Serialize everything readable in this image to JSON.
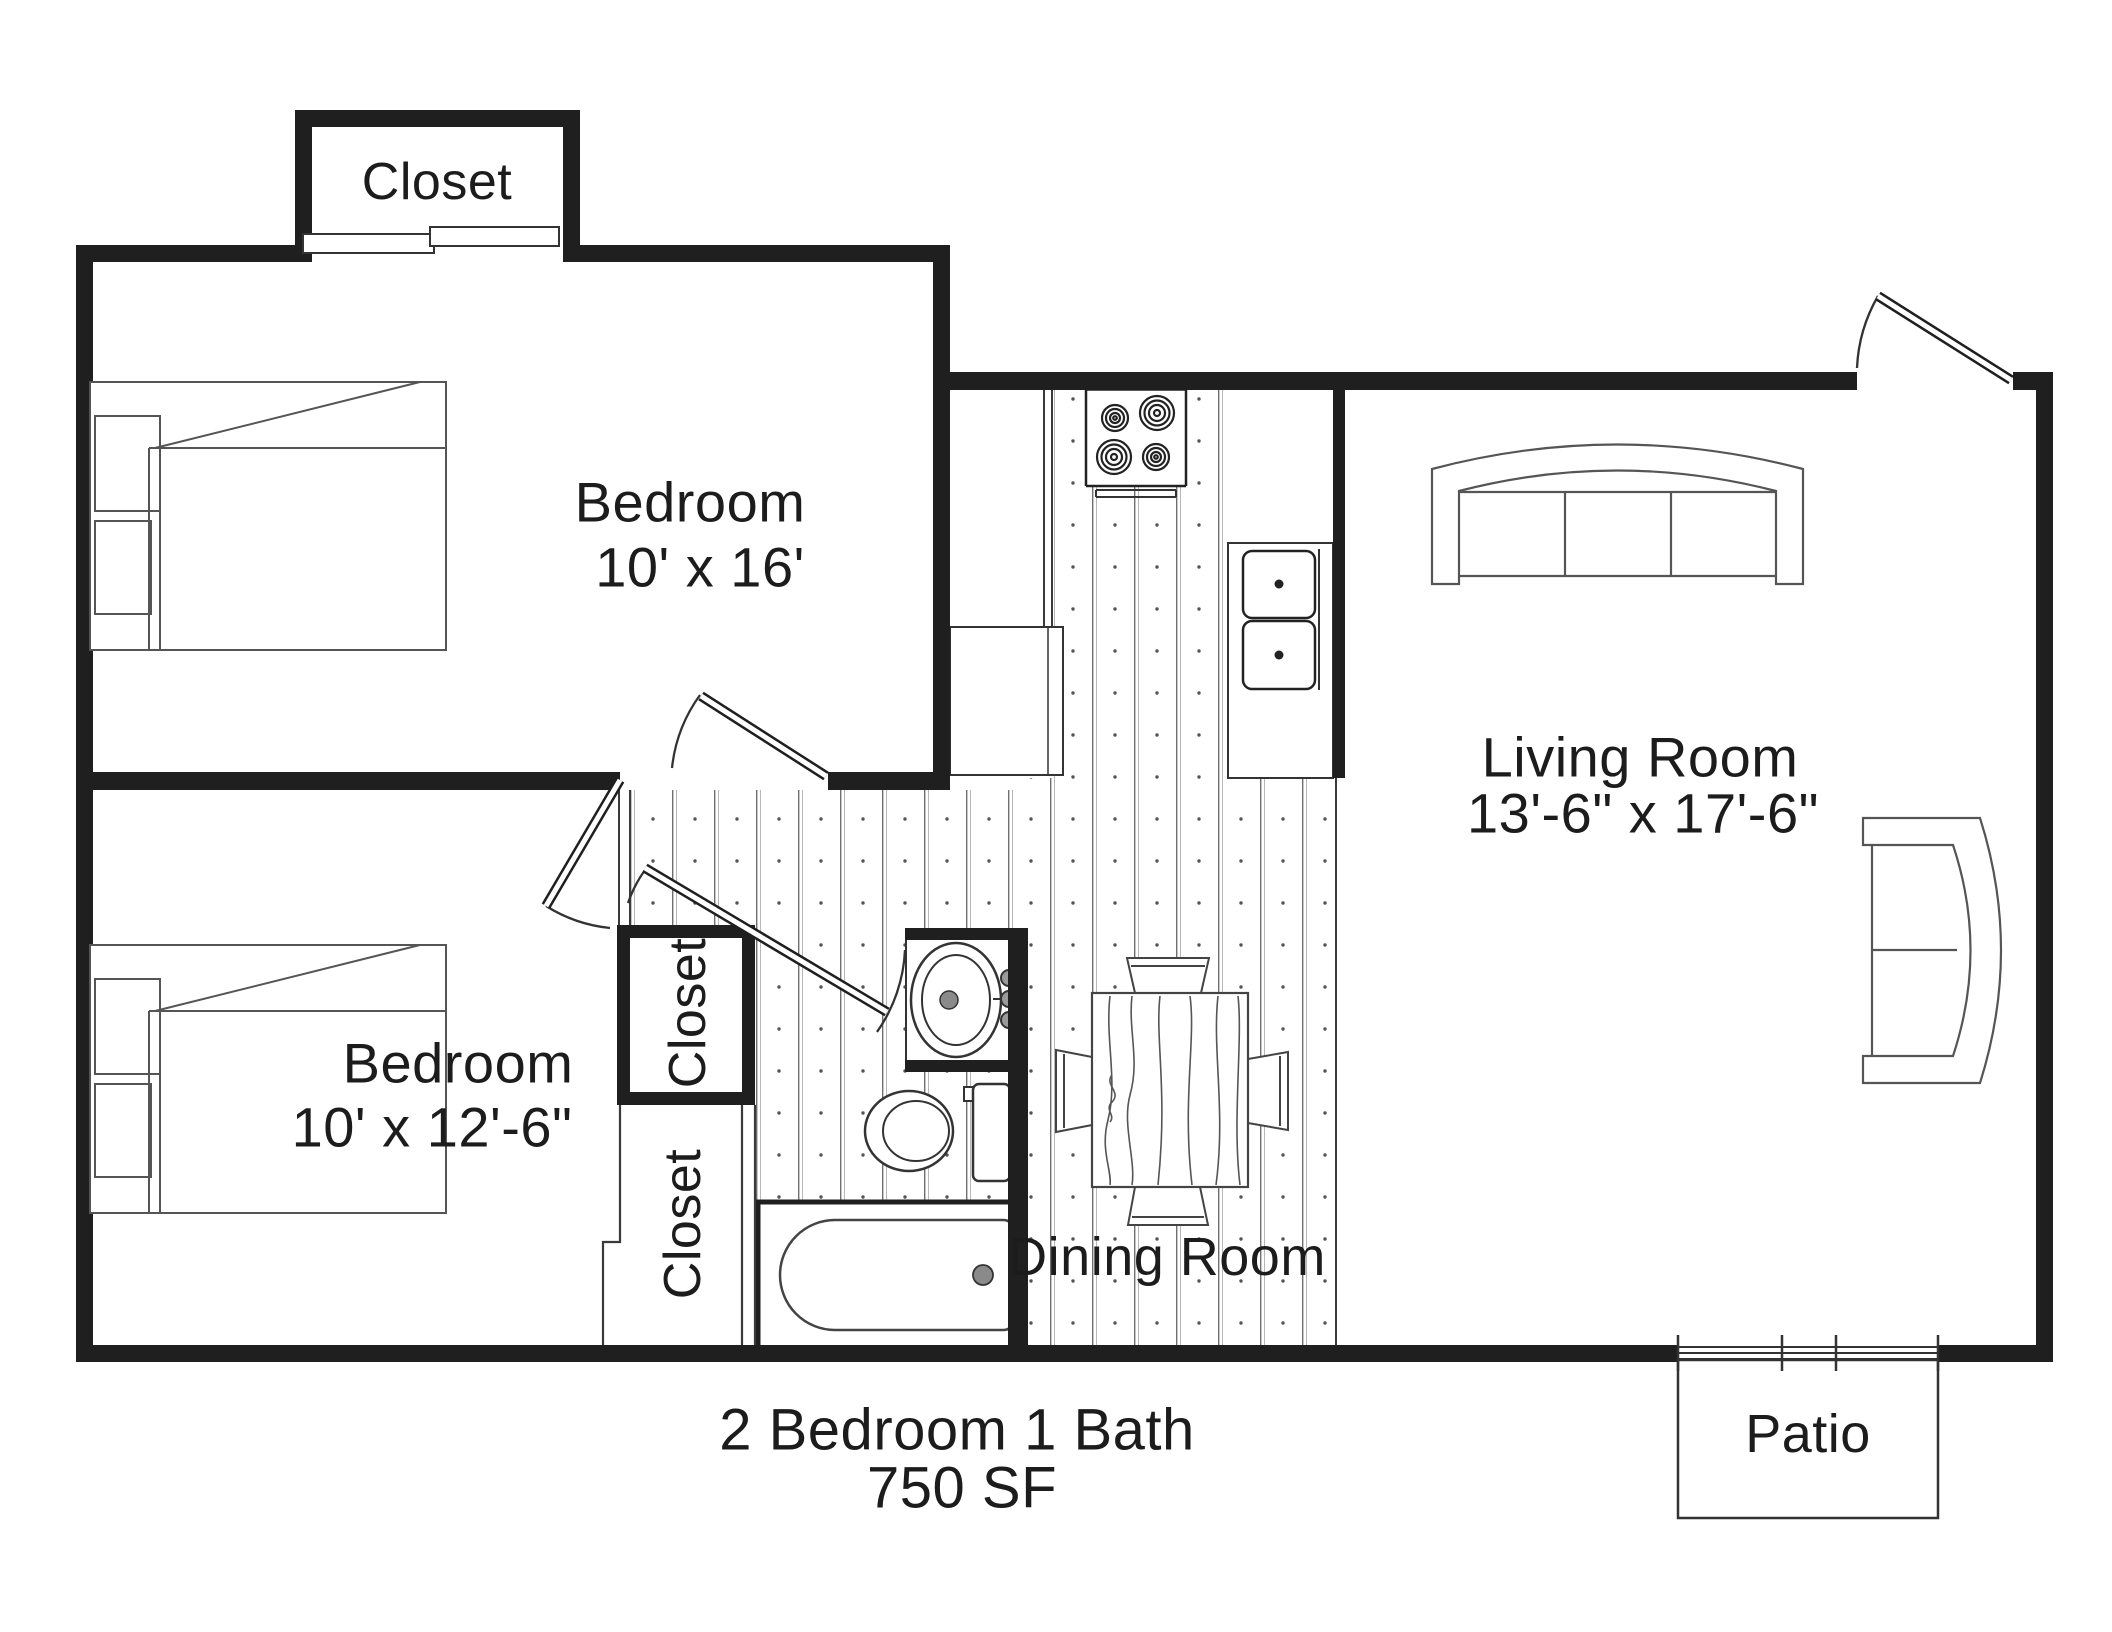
{
  "plan_type": "apartment-floor-plan",
  "colors": {
    "ink": "#1f1f1f",
    "furniture_line": "#555555",
    "paper": "#ffffff"
  },
  "labels": {
    "closet_top": "Closet",
    "bedroom1": {
      "name": "Bedroom",
      "dims": "10' x 16'"
    },
    "bedroom2": {
      "name": "Bedroom",
      "dims": "10' x 12'-6\""
    },
    "living": {
      "name": "Living Room",
      "dims": "13'-6\" x 17'-6\""
    },
    "dining": {
      "name": "Dining Room"
    },
    "closet_hall_upper": "Closet",
    "closet_hall_lower": "Closet",
    "patio": "Patio",
    "summary": {
      "line1": "2 Bedroom 1 Bath",
      "line2": "750 SF"
    }
  },
  "icons": {
    "stove_burners": "4-burner-cooktop",
    "double_sink": "kitchen-double-sink",
    "bath_fixtures": "sink-toilet-bathtub",
    "beds": 2,
    "sofa": "three-cushion-sofa",
    "armchair": "curved-back-chair",
    "dining_table": "wood-table-4-chairs",
    "patio_door": "sliding-door",
    "entry_door": "swing-door"
  }
}
